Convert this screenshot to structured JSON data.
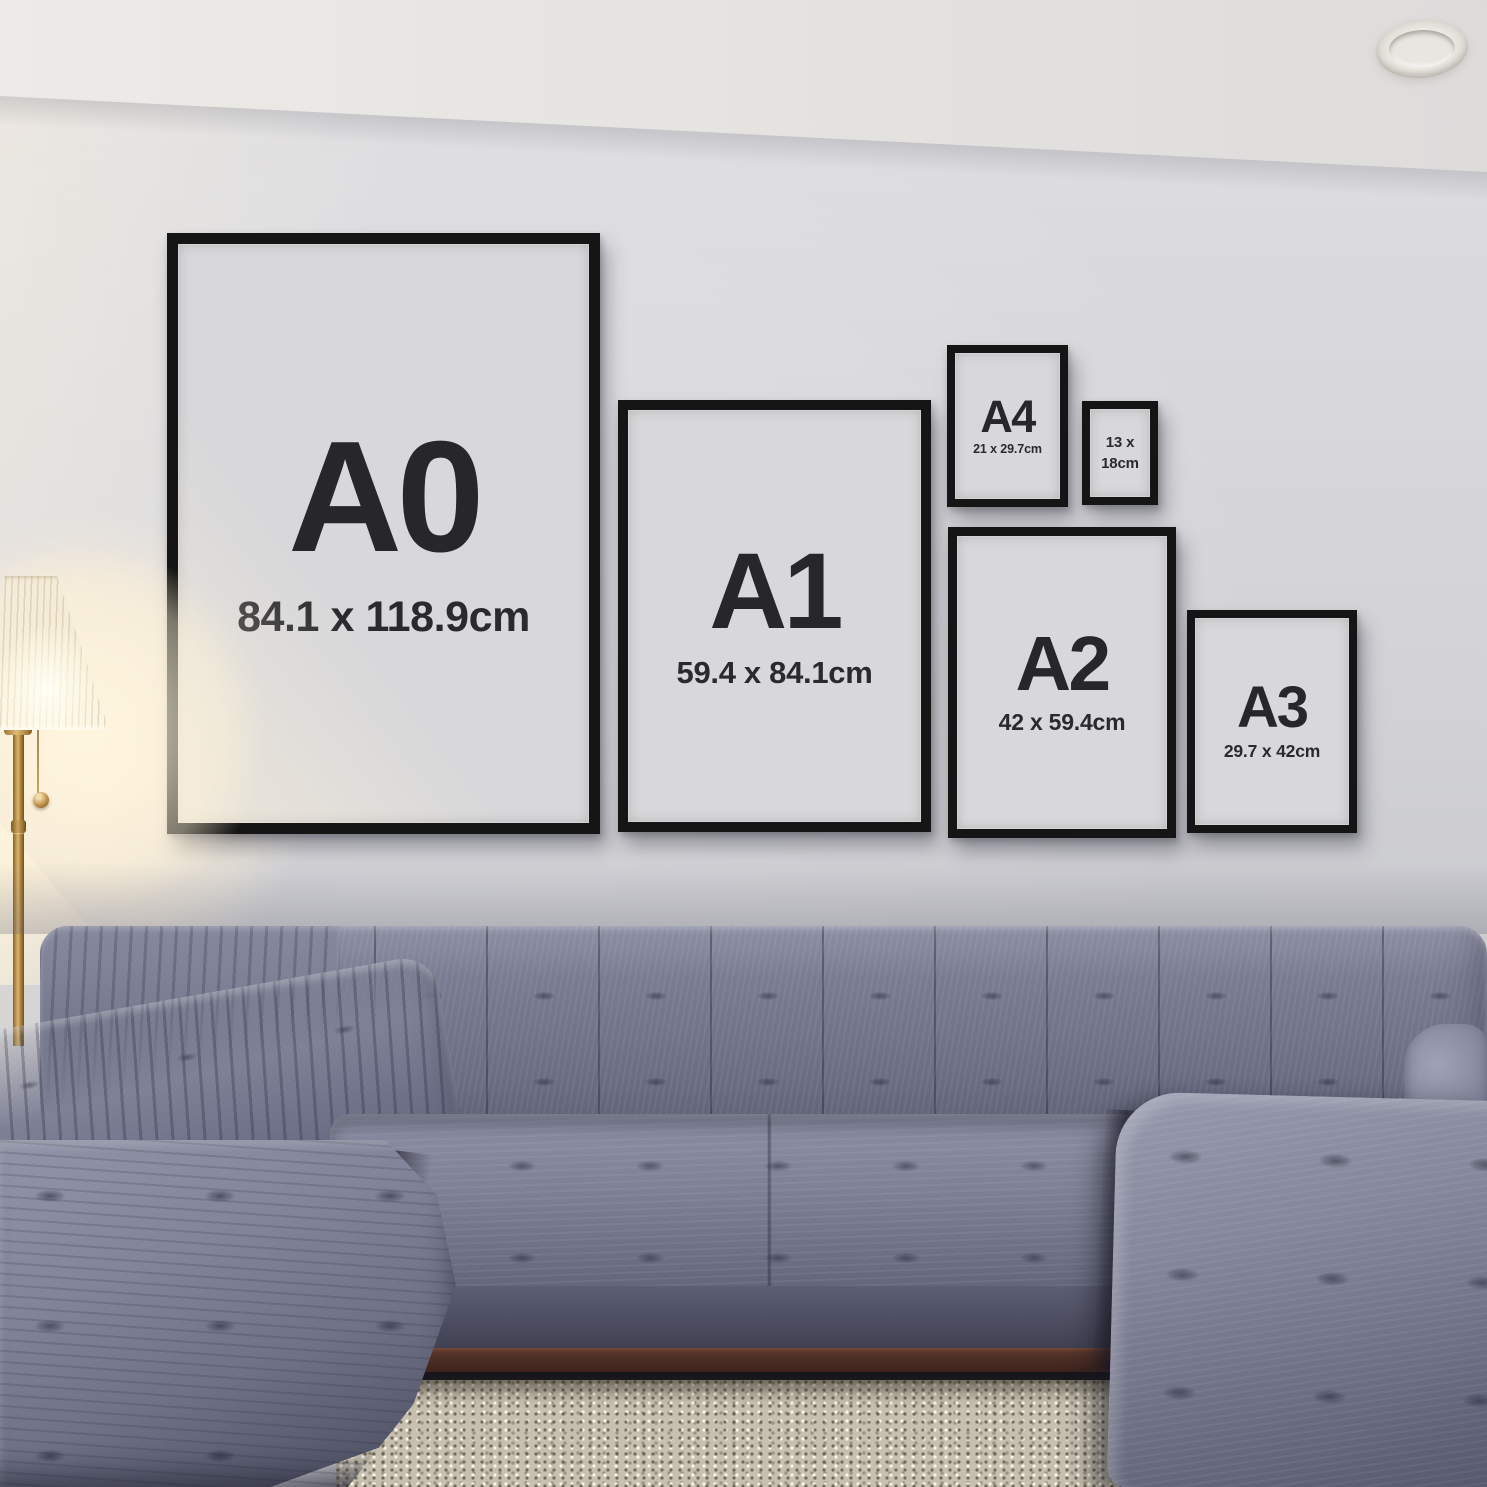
{
  "scene": {
    "description": "Living room wall with black poster frames showing print size guide above a grey tufted sectional sofa, brass floor lamp, shag rug and recessed ceiling spotlight"
  },
  "frames": {
    "a0": {
      "label": "A0",
      "dims": "84.1 x 118.9cm"
    },
    "a1": {
      "label": "A1",
      "dims": "59.4 x 84.1cm"
    },
    "a2": {
      "label": "A2",
      "dims": "42 x 59.4cm"
    },
    "a3": {
      "label": "A3",
      "dims": "29.7 x 42cm"
    },
    "a4": {
      "label": "A4",
      "dims": "21 x 29.7cm"
    },
    "p13x18": {
      "line1": "13 x",
      "line2": "18cm"
    }
  },
  "colors": {
    "frame_black": "#151515",
    "frame_mat": "#d8d8da",
    "label_text": "#27272b",
    "wall": "#d2d2d6",
    "ceiling": "#e8e6e2",
    "sofa_fabric": "#71748a",
    "rug": "#c7c0af",
    "lamp_shade": "#f7eed8",
    "lamp_brass": "#b98d4f",
    "wood_base": "#4a2d23"
  }
}
